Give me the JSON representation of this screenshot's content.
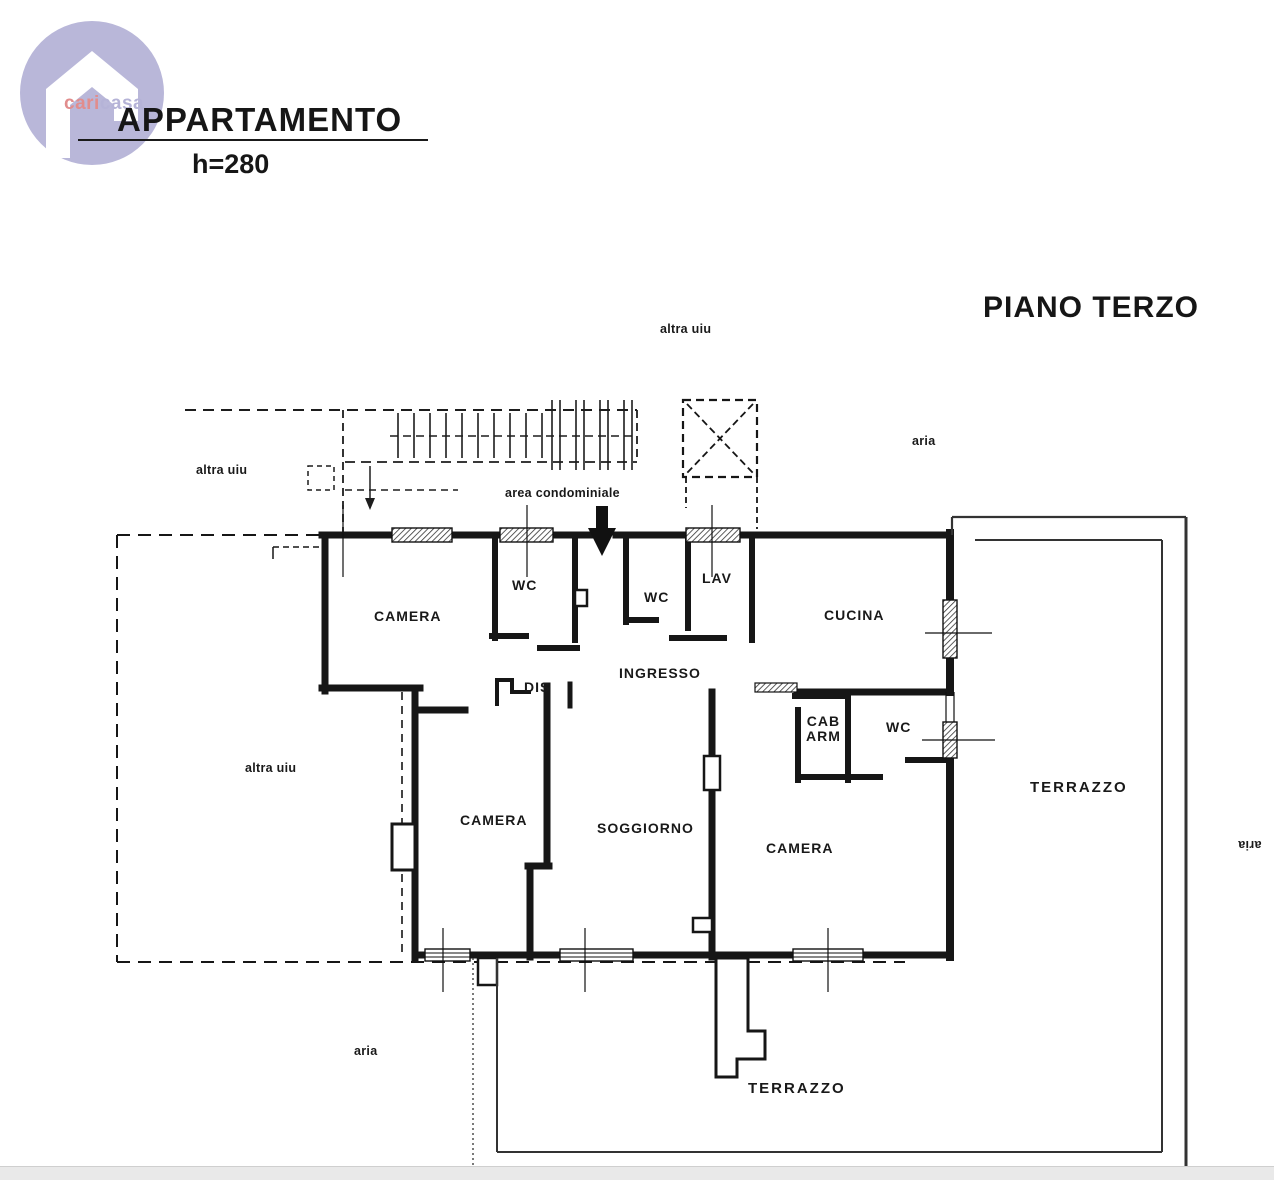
{
  "logo": {
    "brand_first": "cari",
    "brand_second": "casa",
    "circle_color": "#b9b7d9",
    "first_color": "#e18d8d",
    "second_color": "#b5b3d7"
  },
  "header": {
    "title": "APPARTAMENTO",
    "height_note": "h=280"
  },
  "floor": {
    "label": "PIANO TERZO"
  },
  "annotations": {
    "altra_uiu_top": "altra uiu",
    "altra_uiu_left": "altra uiu",
    "altra_uiu_mid": "altra uiu",
    "aria_top_right": "aria",
    "aria_bottom_left": "aria",
    "aria_right_edge": "aria",
    "area_condominiale": "area condominiale"
  },
  "rooms": {
    "camera_top": "CAMERA",
    "wc_top": "WC",
    "wc_mid": "WC",
    "lav": "LAV",
    "cucina": "CUCINA",
    "ingresso": "INGRESSO",
    "dis": "DIS",
    "cab_arm_line1": "CAB",
    "cab_arm_line2": "ARM",
    "wc_right": "WC",
    "camera_left": "CAMERA",
    "soggiorno": "SOGGIORNO",
    "camera_right": "CAMERA",
    "terrazzo_right": "TERRAZZO",
    "terrazzo_bottom": "TERRAZZO"
  },
  "colors": {
    "ink": "#161616",
    "paper": "#ffffff",
    "bottom_bar": "#e9e9e9"
  }
}
